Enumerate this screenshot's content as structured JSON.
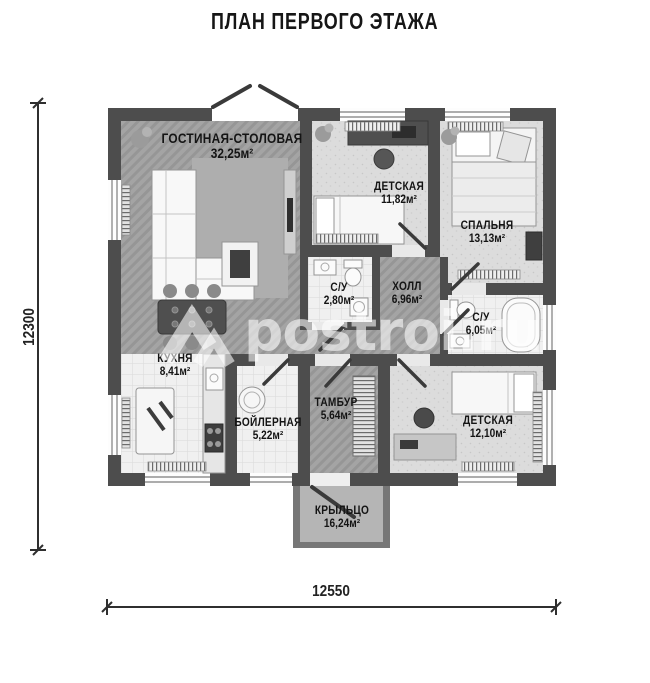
{
  "title": "ПЛАН ПЕРВОГО ЭТАЖА",
  "watermark": {
    "text": "postroi.ru"
  },
  "dimensions": {
    "height_mm": "12300",
    "width_mm": "12550"
  },
  "rooms": [
    {
      "id": "living-dining",
      "name": "ГОСТИНАЯ-СТОЛОВАЯ",
      "area": "32,25м²"
    },
    {
      "id": "kids-room-1",
      "name": "ДЕТСКАЯ",
      "area": "11,82м²"
    },
    {
      "id": "bedroom",
      "name": "СПАЛЬНЯ",
      "area": "13,13м²"
    },
    {
      "id": "bathroom-small",
      "name": "С/У",
      "area": "2,80м²"
    },
    {
      "id": "hall",
      "name": "ХОЛЛ",
      "area": "6,96м²"
    },
    {
      "id": "bathroom-large",
      "name": "С/У",
      "area": "6,05м²"
    },
    {
      "id": "kitchen",
      "name": "КУХНЯ",
      "area": "8,41м²"
    },
    {
      "id": "boiler-room",
      "name": "БОЙЛЕРНАЯ",
      "area": "5,22м²"
    },
    {
      "id": "vestibule",
      "name": "ТАМБУР",
      "area": "5,64м²"
    },
    {
      "id": "kids-room-2",
      "name": "ДЕТСКАЯ",
      "area": "12,10м²"
    },
    {
      "id": "porch",
      "name": "КРЫЛЬЦО",
      "area": "16,24м²"
    }
  ],
  "colors": {
    "wall": "#4d4d4d",
    "floor_wood": "#a2a2a2",
    "floor_tile": "#f0f0f0",
    "floor_speckle": "#dcdcdc",
    "porch": "#b5b5b5",
    "text": "#161616"
  }
}
